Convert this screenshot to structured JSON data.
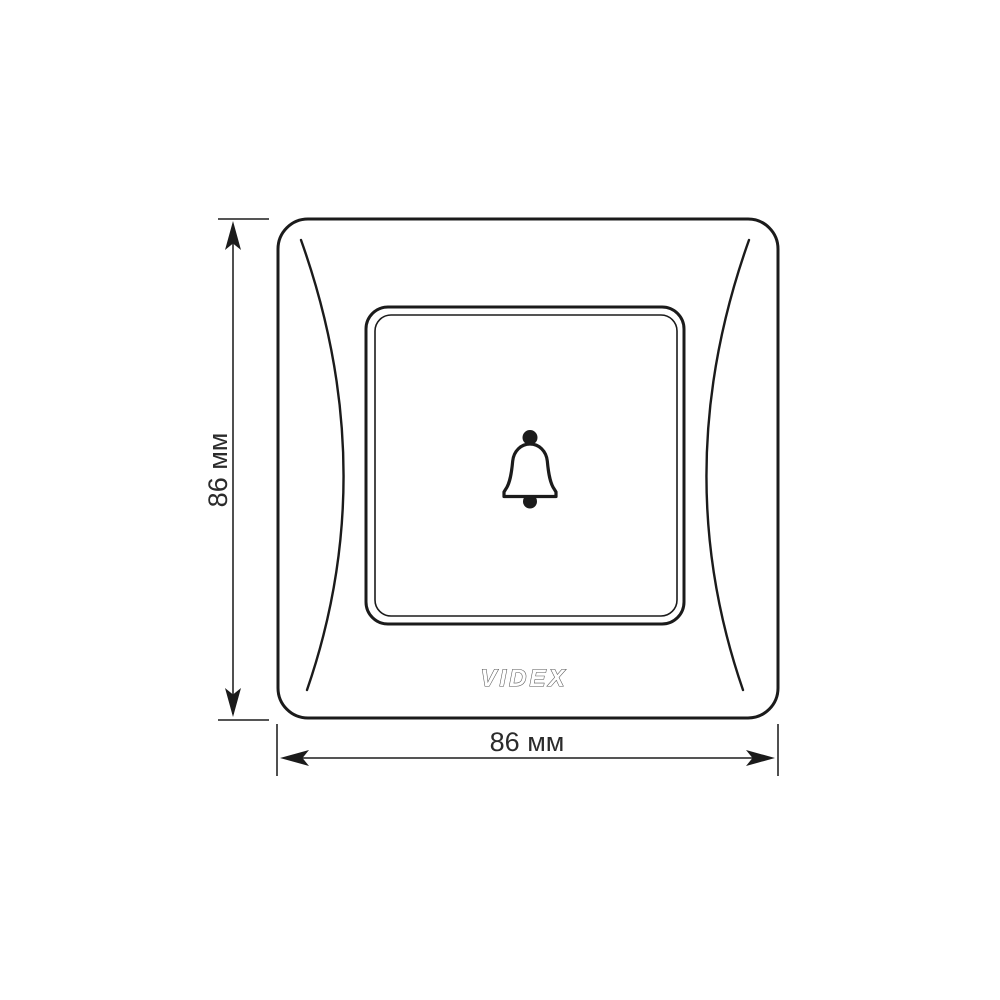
{
  "diagram": {
    "type": "technical-drawing",
    "subject": "VIDEX doorbell switch faceplate, front view with overall dimensions",
    "logo": "VIDEX",
    "dimension_width": "86 мм",
    "dimension_height": "86 мм",
    "icons": [
      "bell-icon"
    ],
    "colors": {
      "line": "#1b1b1b",
      "dimension_line": "#3d3d3d",
      "logo_outline": "#555555",
      "background": "#ffffff"
    }
  }
}
